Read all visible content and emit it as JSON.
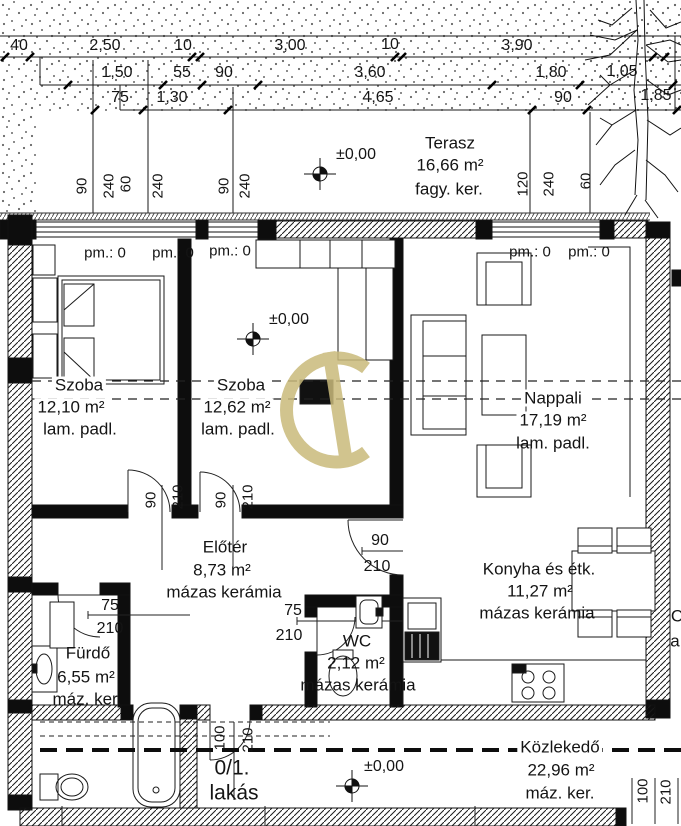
{
  "drawing": {
    "unit_label": {
      "line1": "0/1.",
      "line2": "lakás"
    },
    "level_value": "±0,00",
    "parapet_label": "pm.: 0",
    "edge_fragments": {
      "top": "C",
      "bottom": "a"
    }
  },
  "rooms": {
    "terasz": {
      "name": "Terasz",
      "area": "16,66 m²",
      "floor": "fagy. ker."
    },
    "szoba1": {
      "name": "Szoba",
      "area": "12,10 m²",
      "floor": "lam. padl."
    },
    "szoba2": {
      "name": "Szoba",
      "area": "12,62 m²",
      "floor": "lam. padl."
    },
    "nappali": {
      "name": "Nappali",
      "area": "17,19 m²",
      "floor": "lam. padl."
    },
    "eloter": {
      "name": "Előtér",
      "area": "8,73 m²",
      "floor": "mázas kerámia"
    },
    "furdo": {
      "name": "Fürdő",
      "area": "6,55 m²",
      "floor": "máz. ker."
    },
    "wc": {
      "name": "WC",
      "area": "2,12 m²",
      "floor": "mázas kerámia"
    },
    "konyha": {
      "name": "Konyha és étk.",
      "area": "11,27 m²",
      "floor": "mázas kerámia"
    },
    "kozlekedo": {
      "name": "Közlekedő",
      "area": "22,96 m²",
      "floor": "máz. ker."
    }
  },
  "dimensions": {
    "row1": [
      "40",
      "2,50",
      "10",
      "3,00",
      "10",
      "3,90"
    ],
    "row2": [
      "1,50",
      "55",
      "90",
      "3,60",
      "1,80",
      "1,05"
    ],
    "row3": [
      "75",
      "1,30",
      "4,65",
      "90",
      "1,85"
    ],
    "window_left": [
      "90",
      "240",
      "60",
      "240"
    ],
    "window_mid": [
      "90",
      "240"
    ],
    "window_right": [
      "120",
      "240",
      "60"
    ]
  },
  "doors": {
    "szoba1": {
      "w": "90",
      "h": "210"
    },
    "szoba2": {
      "w": "90",
      "h": "210"
    },
    "konyha": {
      "w": "90",
      "h": "210"
    },
    "furdo": {
      "w": "75",
      "h": "210"
    },
    "wc": {
      "w": "75",
      "h": "210"
    },
    "entrance": {
      "w": "100",
      "h": "210"
    },
    "corridor": {
      "w": "100",
      "h": "210"
    }
  },
  "colors": {
    "watermark": "#c9ba7b",
    "line": "#111111",
    "paper": "#ffffff"
  }
}
